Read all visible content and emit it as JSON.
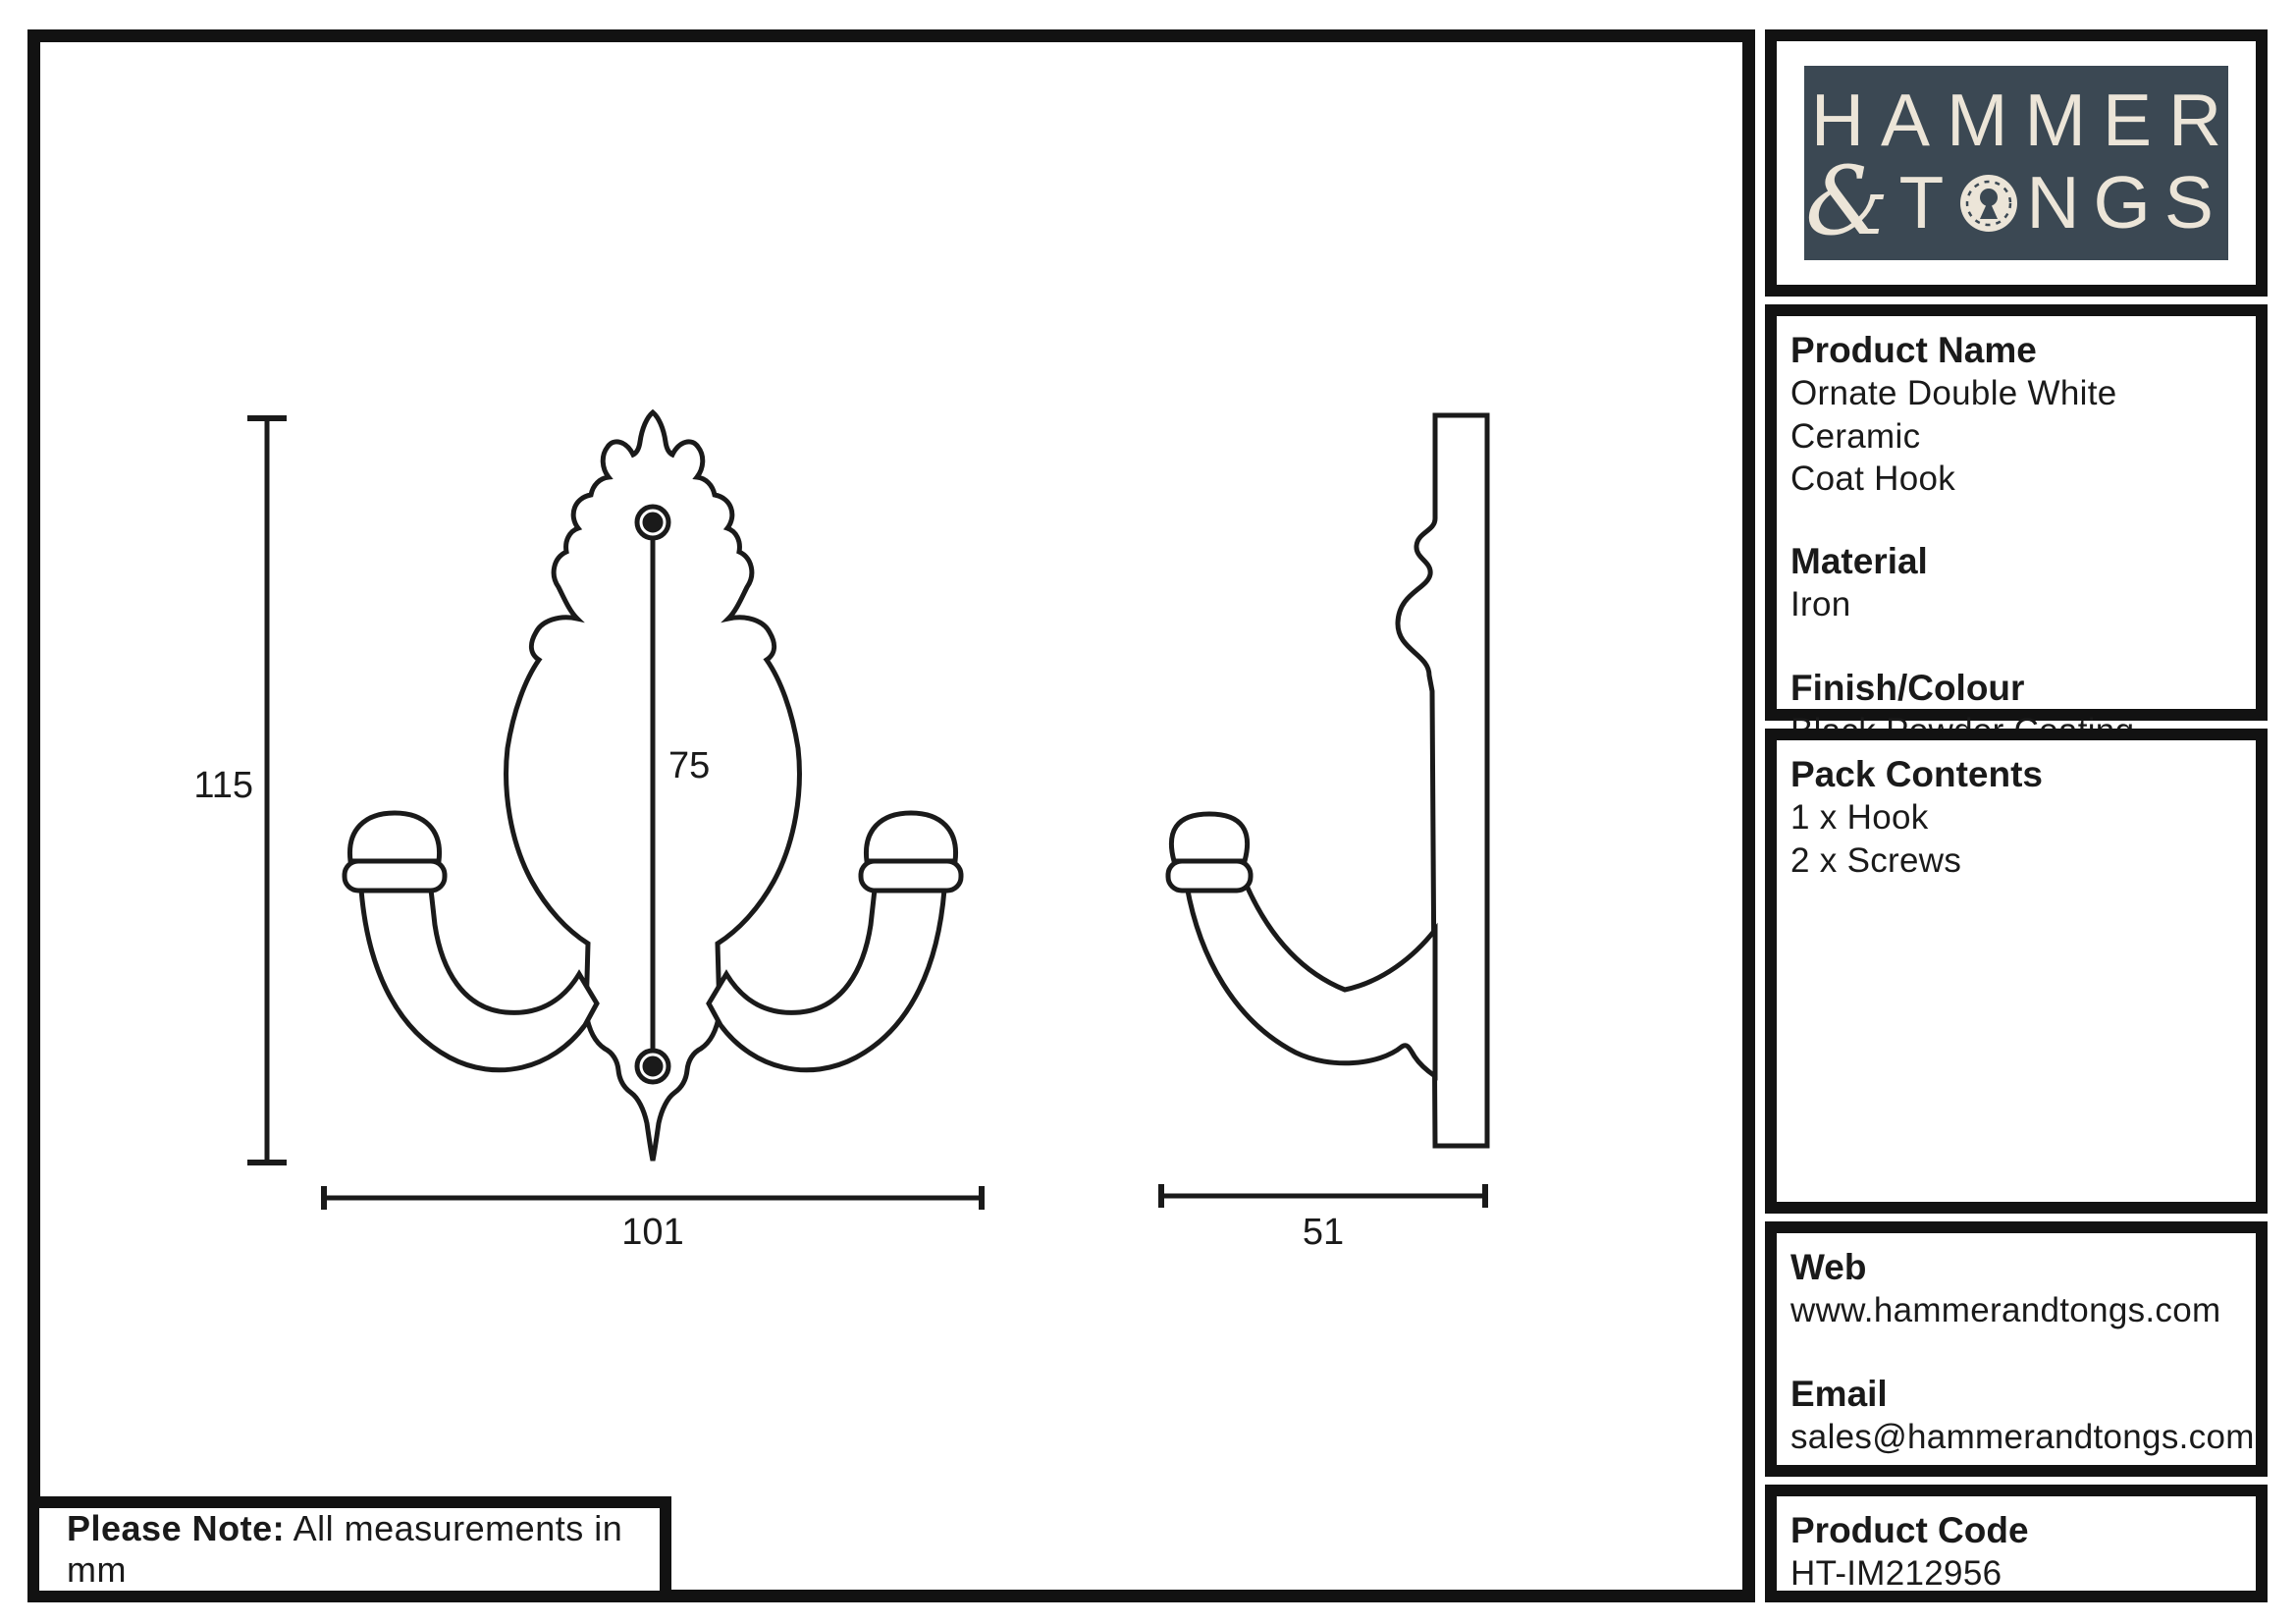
{
  "colors": {
    "line": "#1a1a1a",
    "logo_bg": "#3b4853",
    "logo_text": "#ece5d8",
    "frame": "#121212"
  },
  "logo": {
    "full_name": "HAMMER & TONGS",
    "line1": "HAMMER",
    "ampersand": "&",
    "line2_pre": "T",
    "line2_post": "NGS",
    "keyhole_icon": "keyhole-o"
  },
  "panel": {
    "product_name": {
      "header": "Product Name",
      "value_lines": [
        "Ornate Double White Ceramic",
        "Coat Hook"
      ]
    },
    "material": {
      "header": "Material",
      "value": "Iron"
    },
    "finish": {
      "header": "Finish/Colour",
      "value": "Black Powder Coating"
    },
    "pack": {
      "header": "Pack Contents",
      "items": [
        "1 x Hook",
        "2 x Screws"
      ]
    },
    "web": {
      "header": "Web",
      "value": "www.hammerandtongs.com"
    },
    "email": {
      "header": "Email",
      "value": "sales@hammerandtongs.com"
    },
    "code": {
      "header": "Product Code",
      "value": "HT-IM212956"
    }
  },
  "note": {
    "label": "Please Note:",
    "text": "All measurements in mm"
  },
  "dimensions": {
    "height_mm": "115",
    "hole_spacing_mm": "75",
    "width_mm": "101",
    "depth_mm": "51",
    "units": "mm"
  }
}
